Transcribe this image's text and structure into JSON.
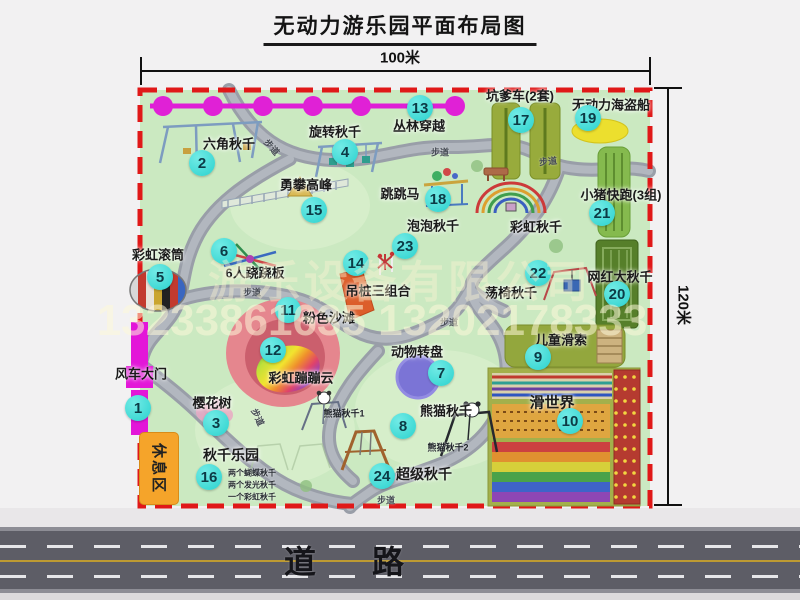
{
  "title": "无动力游乐园平面布局图",
  "dimension_labels": {
    "top": "100米",
    "right": "120米"
  },
  "road_label": "道路",
  "trail_label": "步道",
  "rest_area_label": "休息区",
  "watermark": {
    "company": "游乐设备有限公司",
    "phone": "13233861635 13202178333"
  },
  "colors": {
    "badge": "#2bd2ce",
    "map_border": "#e01818",
    "map_bg": "#cbe9c1",
    "gate": "#e316d8",
    "road": "#5d5d66",
    "rest_area": "#f5a42a"
  },
  "map": {
    "attractions": [
      {
        "num": 1,
        "label": "风车大门",
        "lx": 141,
        "ly": 373,
        "bx": 138,
        "by": 408
      },
      {
        "num": 2,
        "label": "六角秋千",
        "lx": 229,
        "ly": 143,
        "bx": 202,
        "by": 163
      },
      {
        "num": 3,
        "label": "樱花树",
        "lx": 212,
        "ly": 402,
        "bx": 216,
        "by": 423
      },
      {
        "num": 4,
        "label": "旋转秋千",
        "lx": 335,
        "ly": 131,
        "bx": 345,
        "by": 152
      },
      {
        "num": 5,
        "label": "彩虹滚筒",
        "lx": 158,
        "ly": 254,
        "bx": 160,
        "by": 277
      },
      {
        "num": 6,
        "label": "6人跷跷板",
        "lx": 255,
        "ly": 272,
        "bx": 224,
        "by": 251
      },
      {
        "num": 7,
        "label": "动物转盘",
        "lx": 417,
        "ly": 351,
        "bx": 441,
        "by": 373
      },
      {
        "num": 8,
        "label": "熊猫秋千",
        "lx": 446,
        "ly": 410,
        "bx": 403,
        "by": 426
      },
      {
        "num": 9,
        "label": "儿童滑索",
        "lx": 561,
        "ly": 339,
        "bx": 538,
        "by": 357
      },
      {
        "num": 10,
        "label": "滑世界",
        "lx": 552,
        "ly": 402,
        "bx": 570,
        "by": 421,
        "size": 15
      },
      {
        "num": 11,
        "label": "粉色沙滩",
        "lx": 329,
        "ly": 317,
        "bx": 288,
        "by": 310
      },
      {
        "num": 12,
        "label": "彩虹蹦蹦云",
        "lx": 301,
        "ly": 377,
        "bx": 273,
        "by": 350
      },
      {
        "num": 13,
        "label": "丛林穿越",
        "lx": 419,
        "ly": 125,
        "bx": 420,
        "by": 108
      },
      {
        "num": 14,
        "label": "吊桩三组合",
        "lx": 378,
        "ly": 290,
        "bx": 356,
        "by": 263
      },
      {
        "num": 15,
        "label": "勇攀高峰",
        "lx": 306,
        "ly": 184,
        "bx": 314,
        "by": 210
      },
      {
        "num": 16,
        "label": "秋千乐园",
        "lx": 231,
        "ly": 455,
        "bx": 209,
        "by": 477,
        "size": 14
      },
      {
        "num": 17,
        "label": "坑爹车(2套)",
        "lx": 520,
        "ly": 95,
        "bx": 521,
        "by": 120
      },
      {
        "num": 18,
        "label": "跳跳马",
        "lx": 400,
        "ly": 193,
        "bx": 438,
        "by": 199
      },
      {
        "num": 19,
        "label": "无动力海盗船",
        "lx": 611,
        "ly": 104,
        "bx": 588,
        "by": 118
      },
      {
        "num": 20,
        "label": "网红大秋千",
        "lx": 620,
        "ly": 276,
        "bx": 617,
        "by": 294
      },
      {
        "num": 21,
        "label": "小猪快跑(3组)",
        "lx": 621,
        "ly": 194,
        "bx": 602,
        "by": 213
      },
      {
        "num": 22,
        "label": "荡椅秋千",
        "lx": 511,
        "ly": 292,
        "bx": 538,
        "by": 273
      },
      {
        "num": 23,
        "label": "泡泡秋千",
        "lx": 433,
        "ly": 225,
        "bx": 405,
        "by": 246
      },
      {
        "num": 24,
        "label": "超级秋千",
        "lx": 424,
        "ly": 474,
        "bx": 382,
        "by": 476,
        "size": 14
      },
      {
        "num": "",
        "label": "彩虹秋千",
        "lx": 536,
        "ly": 226,
        "bx": -100,
        "by": -100
      }
    ],
    "trail_positions": [
      {
        "x": 440,
        "y": 152,
        "r": 0
      },
      {
        "x": 548,
        "y": 161,
        "r": -6
      },
      {
        "x": 252,
        "y": 292,
        "r": 0
      },
      {
        "x": 449,
        "y": 322,
        "r": 0
      },
      {
        "x": 386,
        "y": 500,
        "r": 0
      },
      {
        "x": 258,
        "y": 417,
        "r": 65
      },
      {
        "x": 272,
        "y": 147,
        "r": 48
      }
    ],
    "sub_labels": [
      {
        "text": "熊猫秋千1",
        "x": 344,
        "y": 413
      },
      {
        "text": "熊猫秋千2",
        "x": 448,
        "y": 447
      }
    ],
    "swing_notes": {
      "x": 252,
      "y": 473,
      "lines": [
        "两个蝴蝶秋千",
        "两个发光秋千",
        "一个彩虹秋千"
      ]
    }
  }
}
